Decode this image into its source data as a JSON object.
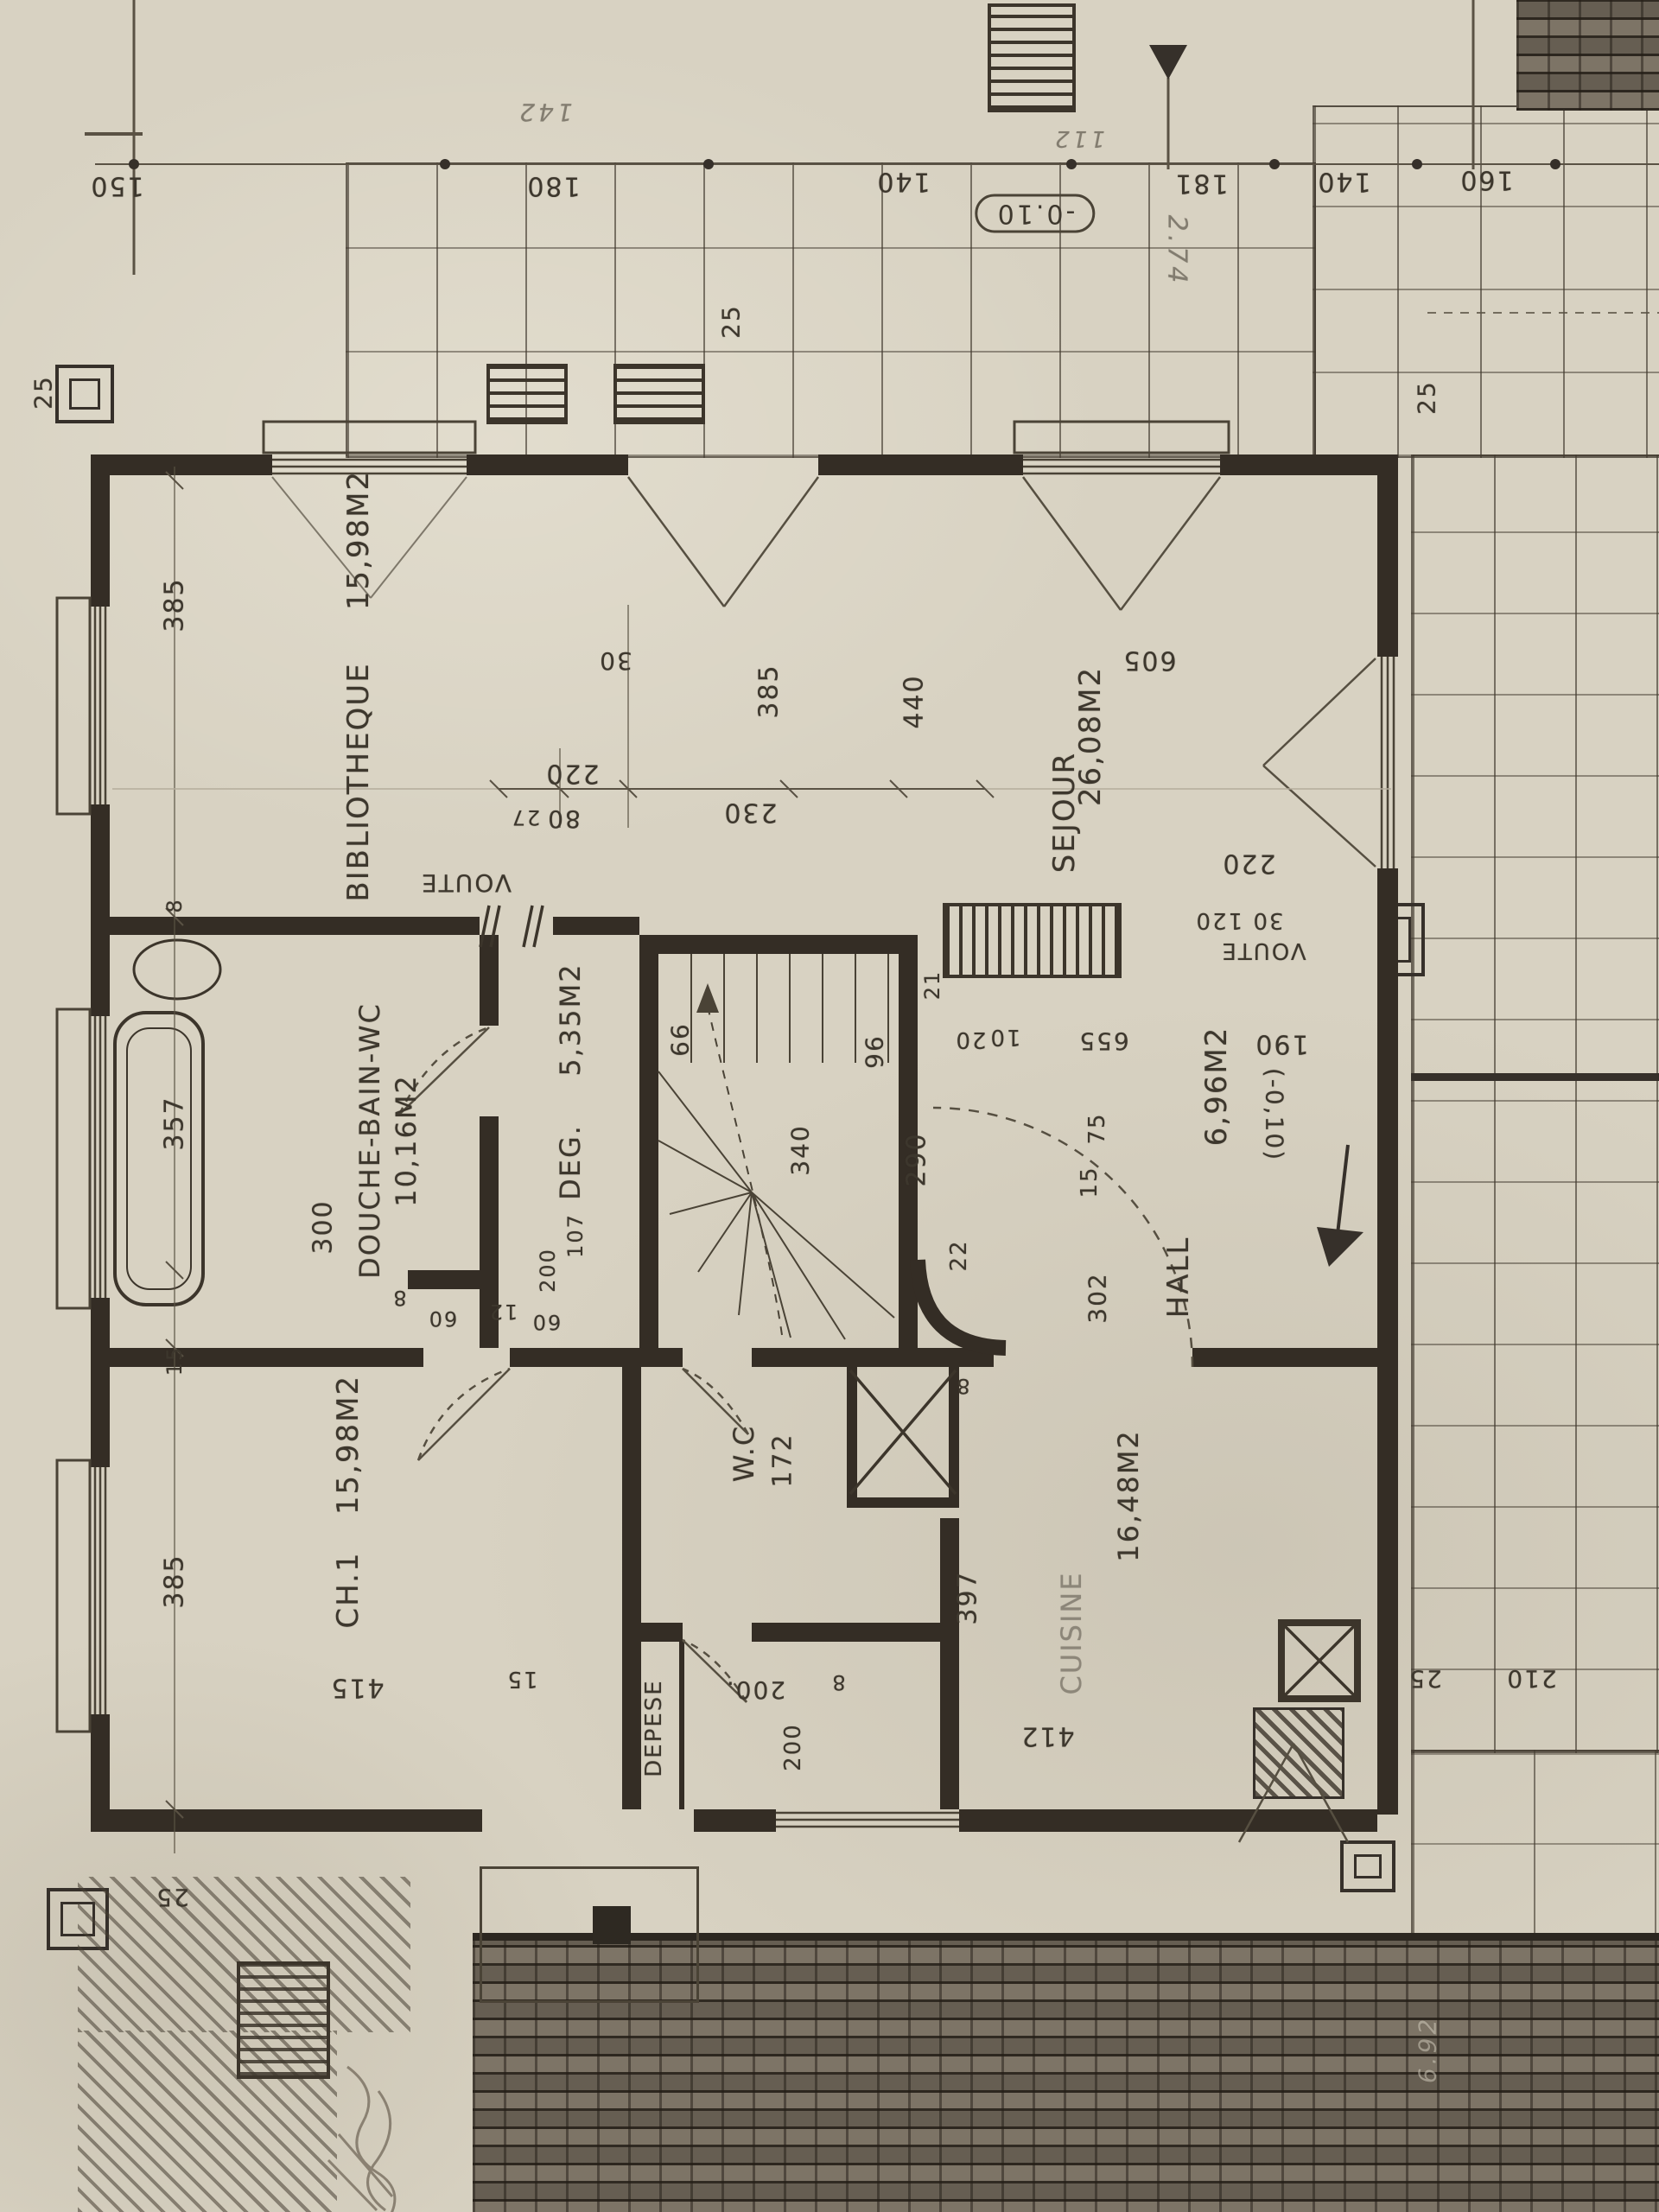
{
  "plan": {
    "rooms": {
      "bibliotheque": {
        "label": "BIBLIOTHEQUE",
        "area": "15,98M2"
      },
      "sejour": {
        "label": "SEJOUR",
        "area": "26,08M2"
      },
      "douche_bain_wc": {
        "label": "DOUCHE-BAIN-WC",
        "area": "10,16M2"
      },
      "degagement": {
        "label": "DEG.",
        "area": "5,35M2"
      },
      "chambre_1": {
        "label": "CH.1",
        "area": "15,98M2"
      },
      "wc": {
        "label": "W.C"
      },
      "hall": {
        "label": "HALL",
        "area": "6,96M2"
      },
      "cuisine": {
        "label": "CUISINE",
        "area": "16,48M2"
      },
      "depense": {
        "label": "DEPESE"
      }
    },
    "annotations": {
      "voute_center": "VOUTE",
      "voute_right": "VOUTE",
      "level_terrace_top": "-0.10",
      "level_terrace_right": "(-0,10)",
      "hand_274": "2.74",
      "hand_142": "142",
      "hand_112": "112",
      "hand_692": "6.92"
    },
    "dims": {
      "top_150": "150",
      "top_180": "180",
      "top_140a": "140",
      "top_181": "181",
      "top_140b": "140",
      "top_160": "160",
      "left_25_top": "25",
      "left_385_a": "385",
      "left_8": "8",
      "left_357": "357",
      "left_300": "300",
      "left_15": "15",
      "left_385_b": "385",
      "left_415": "415",
      "left_15_b": "15",
      "left_25_bottom": "25",
      "terrace_25": "25",
      "right_25_top": "25",
      "mid_30": "30",
      "mid_220": "220",
      "mid_27": "27",
      "mid_80": "80",
      "mid_230": "230",
      "mid_385": "385",
      "mid_440": "440",
      "mid_605": "605",
      "stair_66": "66",
      "stair_96": "96",
      "stair_340": "340",
      "stair_290": "290",
      "stair_20": "20",
      "stair_10": "10",
      "stair_21": "21",
      "stair_655": "655",
      "stair_75": "75",
      "stair_15": "15",
      "stair_302": "302",
      "stair_22": "22",
      "stair_107": "107",
      "stair_200": "200",
      "bath_8": "8",
      "bath_60a": "60",
      "bath_12": "12",
      "bath_60b": "60",
      "right_220": "220",
      "right_30_120": "30 120",
      "right_190": "190",
      "wc_8": "8",
      "wc_172": "172",
      "wc_397": "397",
      "store_200": "200.",
      "store_200v": "200",
      "store_8": "8",
      "cuisine_412": "412",
      "br_210": "210",
      "br_25": "25"
    }
  }
}
